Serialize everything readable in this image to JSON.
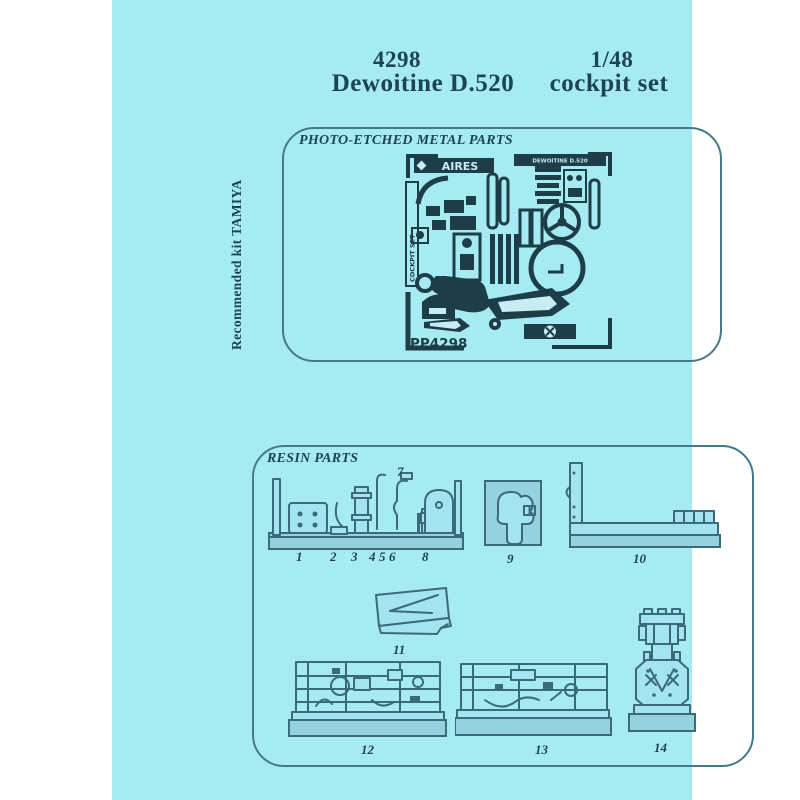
{
  "page": {
    "colors": {
      "paper": "#a6eaf2",
      "ink": "#1c4553",
      "drawing": "#3a6b7a",
      "fret": "#1d3e49",
      "part_fill": "#a3e4ee",
      "block_fill": "#95d2de",
      "border": "#44798a"
    }
  },
  "header": {
    "product_number": "4298",
    "scale": "1/48",
    "product_name": "Dewoitine D.520",
    "product_type": "cockpit set"
  },
  "side_note": "Recommended kit TAMIYA",
  "photo_etched_box": {
    "title": "PHOTO-ETCHED METAL PARTS",
    "fret_brand": "AIRES",
    "fret_model": "DEWOITINE D.520",
    "fret_side_label": "COCKPIT SET",
    "fret_code": "PP4298"
  },
  "resin_box": {
    "title": "RESIN PARTS",
    "labels": {
      "n1": "1",
      "n2": "2",
      "n3": "3",
      "n4": "4",
      "n5": "5",
      "n6": "6",
      "n7": "7",
      "n8": "8",
      "n9": "9",
      "n10": "10",
      "n11": "11",
      "n12": "12",
      "n13": "13",
      "n14": "14"
    }
  }
}
